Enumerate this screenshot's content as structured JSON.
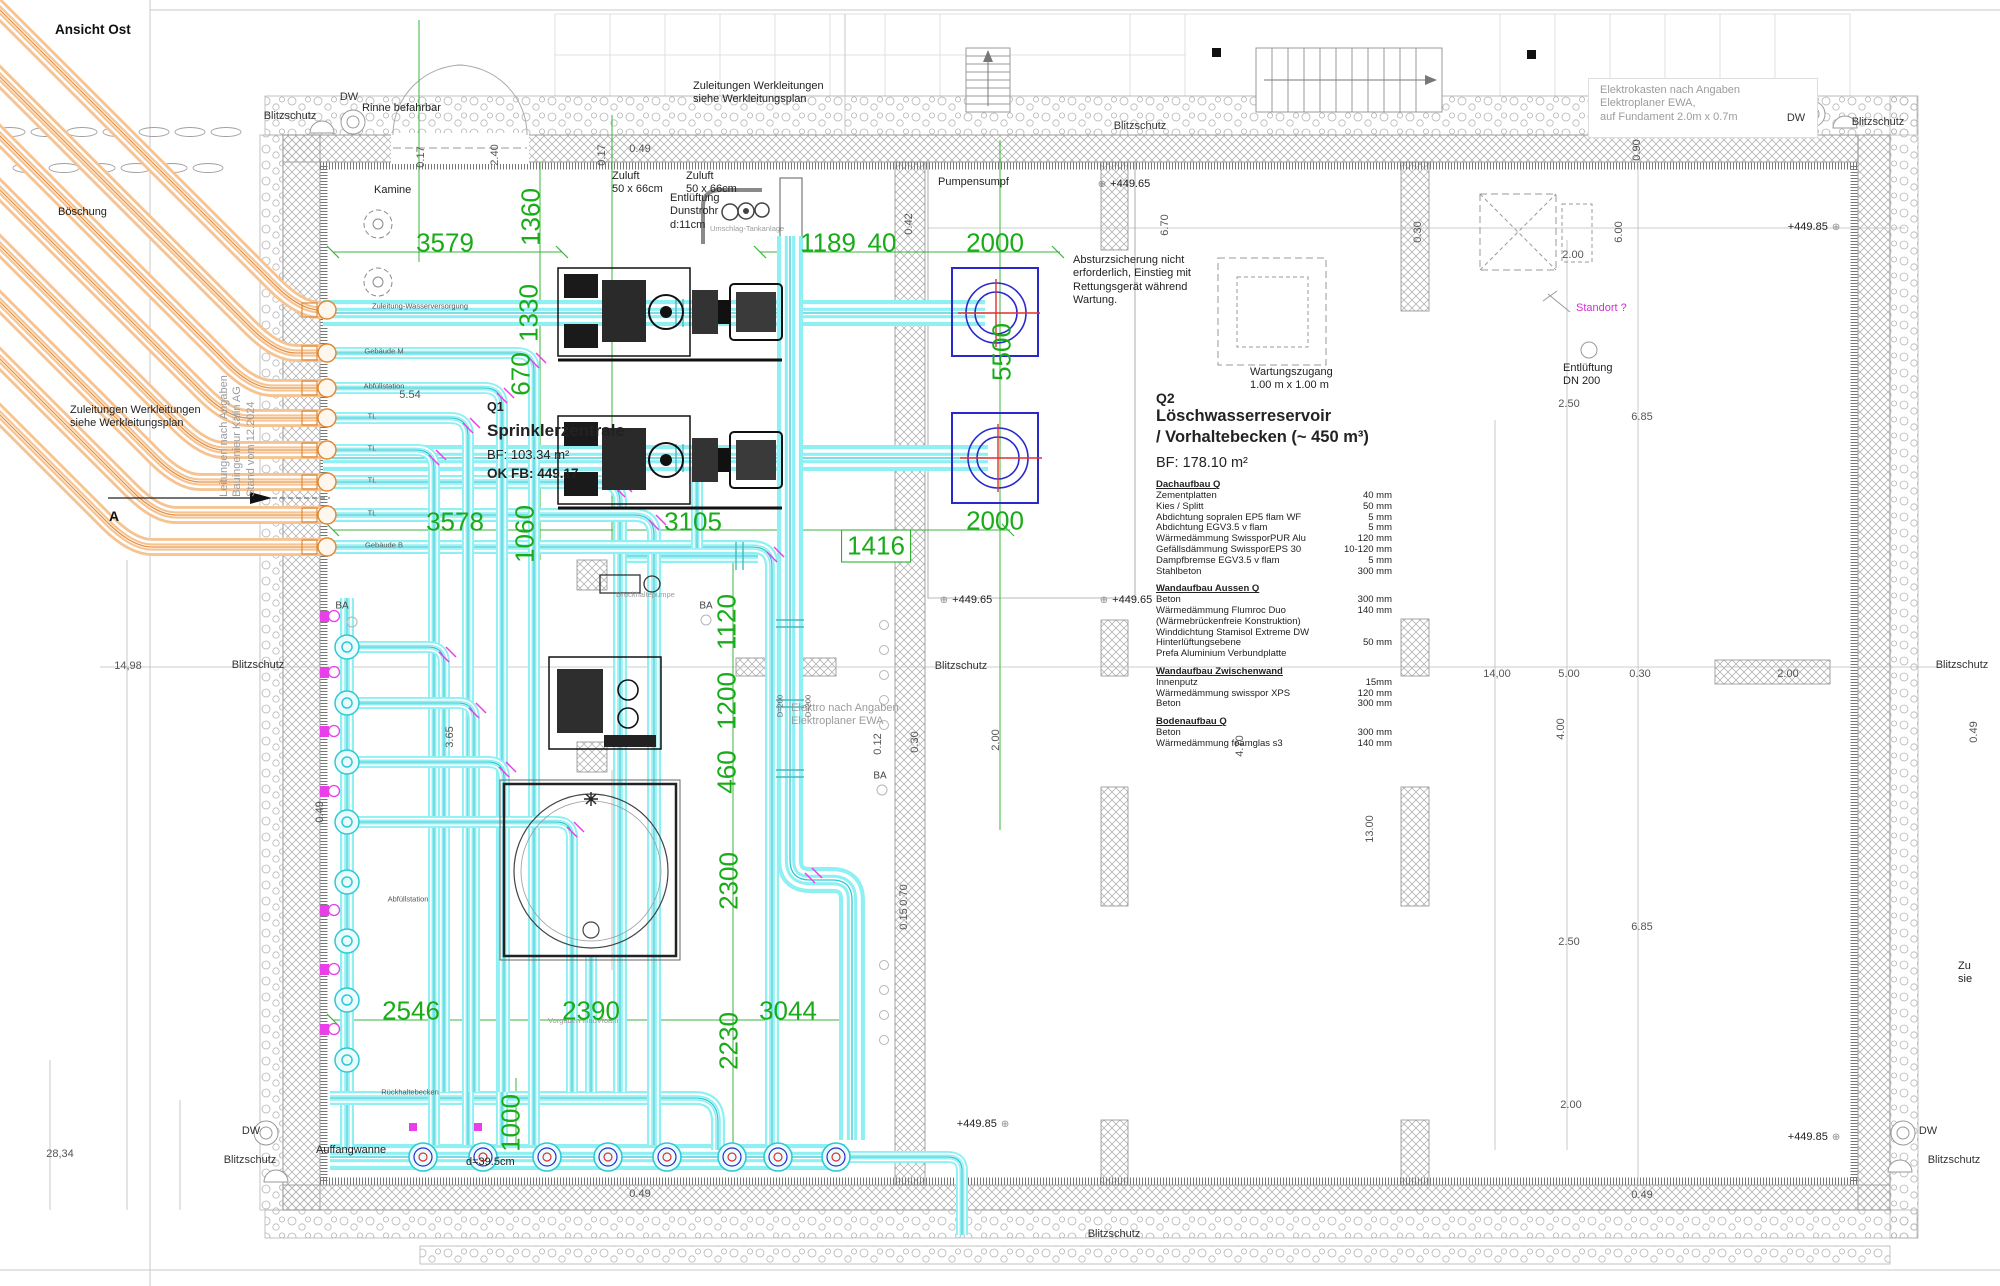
{
  "view_label": "Ansicht Ost",
  "colors": {
    "dimension_green": "#1aab1a",
    "pipe_cyan": "#7fedf2",
    "pipe_orange": "#f6c392",
    "pump_blue": "#2a2acc",
    "marker_magenta": "#e93fe9",
    "cross_red": "#e03030",
    "wall_gray": "#9a9a9a"
  },
  "rooms": {
    "q1": {
      "code": "Q1",
      "name": "Sprinklerzentrale",
      "bf": "BF: 103.34 m²",
      "ok_fb": "OK FB: 449.17"
    },
    "q2": {
      "code": "Q2",
      "title": [
        "Löschwasserreservoir",
        "/ Vorhaltebecken (~ 450 m³)"
      ],
      "bf": "BF: 178.10 m²",
      "sections": [
        {
          "h": "Dachaufbau Q",
          "rows": [
            [
              "Zementplatten",
              "40 mm"
            ],
            [
              "Kies / Splitt",
              "50 mm"
            ],
            [
              "Abdichtung sopralen EP5 flam WF",
              "5 mm"
            ],
            [
              "Abdichtung EGV3.5 v flam",
              "5 mm"
            ],
            [
              "Wärmedämmung SwissporPUR Alu",
              "120 mm"
            ],
            [
              "Gefällsdämmung SwissporEPS 30",
              "10-120 mm"
            ],
            [
              "Dampfbremse EGV3.5 v flam",
              "5 mm"
            ],
            [
              "Stahlbeton",
              "300 mm"
            ]
          ]
        },
        {
          "h": "Wandaufbau Aussen Q",
          "rows": [
            [
              "Beton",
              "300 mm"
            ],
            [
              "Wärmedämmung Flumroc Duo",
              "140 mm"
            ],
            [
              "(Wärmebrückenfreie Konstruktion)",
              ""
            ],
            [
              "Winddichtung Stamisol Extreme DW",
              ""
            ],
            [
              "Hinterlüftungsebene",
              "50 mm"
            ],
            [
              "Prefa Aluminium Verbundplatte",
              ""
            ]
          ]
        },
        {
          "h": "Wandaufbau Zwischenwand",
          "rows": [
            [
              "Innenputz",
              "15mm"
            ],
            [
              "Wärmedämmung swisspor XPS",
              "120 mm"
            ],
            [
              "Beton",
              "300 mm"
            ]
          ]
        },
        {
          "h": "Bodenaufbau Q",
          "rows": [
            [
              "Beton",
              "300 mm"
            ],
            [
              "Wärmedämmung foamglas s3",
              "140 mm"
            ]
          ]
        }
      ]
    }
  },
  "annotations": {
    "notes": [
      {
        "t": [
          "Zuleitungen Werkleitungen",
          "siehe Werkleitungsplan"
        ],
        "x": 693,
        "y": 80
      },
      {
        "t": [
          "Zuleitungen Werkleitungen",
          "siehe Werkleitungsplan"
        ],
        "x": 70,
        "y": 404
      },
      {
        "t": [
          "Elektrokasten nach Angaben",
          "Elektroplaner EWA,",
          "auf Fundament 2.0m x 0.7m"
        ],
        "x": 1600,
        "y": 84,
        "cls": "gray"
      },
      {
        "t": [
          "Absturzsicherung nicht",
          "erforderlich, Einstieg mit",
          "Rettungsgerät während",
          "Wartung."
        ],
        "x": 1073,
        "y": 254
      },
      {
        "t": [
          "Wartungszugang",
          "1.00 m x 1.00 m"
        ],
        "x": 1250,
        "y": 366
      },
      {
        "t": [
          "Elektro nach Angaben",
          "Elektroplaner EWA"
        ],
        "x": 791,
        "y": 702,
        "cls": "gray"
      },
      {
        "t": [
          "Entlüftung",
          "DN 200"
        ],
        "x": 1563,
        "y": 362
      },
      {
        "t": [
          "Zuluft",
          "50 x 66cm"
        ],
        "x": 612,
        "y": 170
      },
      {
        "t": [
          "Zuluft",
          "50 x 66cm"
        ],
        "x": 686,
        "y": 170
      },
      {
        "t": [
          "Entlüftung",
          "Dunstrohr",
          "d:11cm"
        ],
        "x": 670,
        "y": 192
      },
      {
        "t": [
          "Böschung"
        ],
        "x": 58,
        "y": 206
      },
      {
        "t": [
          "Rinne befahrbar"
        ],
        "x": 362,
        "y": 102
      },
      {
        "t": [
          "Kamine"
        ],
        "x": 374,
        "y": 184
      },
      {
        "t": [
          "Pumpensumpf"
        ],
        "x": 938,
        "y": 176
      },
      {
        "t": [
          "Standort ?"
        ],
        "x": 1576,
        "y": 302,
        "cls": "mag"
      },
      {
        "t": [
          "Auffangwanne"
        ],
        "x": 316,
        "y": 1144
      },
      {
        "t": [
          "Zu",
          "sie"
        ],
        "x": 1958,
        "y": 960
      },
      {
        "t": [
          "Leitungen nach Angaben",
          "Bauingenieur Kälin AG",
          "Stand vom 12.2024"
        ],
        "x": 238,
        "y": 436,
        "cls": "gray",
        "rot": -90
      },
      {
        "t": [
          "Umschlag-Tankanlage"
        ],
        "x": 710,
        "y": 224,
        "cls": "tiny gray"
      },
      {
        "t": [
          "d=39.5cm"
        ],
        "x": 466,
        "y": 1156
      },
      {
        "t": [
          "Vorgaben InnoVfoam"
        ],
        "x": 548,
        "y": 1016,
        "cls": "tiny gray"
      },
      {
        "t": [
          "Druckhaltepumpe"
        ],
        "x": 616,
        "y": 590,
        "cls": "tiny gray"
      }
    ],
    "labels": [
      {
        "t": "Blitzschutz",
        "x": 290,
        "y": 116
      },
      {
        "t": "Blitzschutz",
        "x": 1140,
        "y": 126
      },
      {
        "t": "Blitzschutz",
        "x": 1878,
        "y": 122
      },
      {
        "t": "Blitzschutz",
        "x": 258,
        "y": 665
      },
      {
        "t": "Blitzschutz",
        "x": 961,
        "y": 666
      },
      {
        "t": "Blitzschutz",
        "x": 1962,
        "y": 665
      },
      {
        "t": "Blitzschutz",
        "x": 250,
        "y": 1160
      },
      {
        "t": "Blitzschutz",
        "x": 1954,
        "y": 1160
      },
      {
        "t": "Blitzschutz",
        "x": 1114,
        "y": 1234
      },
      {
        "t": "DW",
        "x": 349,
        "y": 97
      },
      {
        "t": "DW",
        "x": 1796,
        "y": 118
      },
      {
        "t": "DW",
        "x": 251,
        "y": 1131
      },
      {
        "t": "DW",
        "x": 1928,
        "y": 1131
      },
      {
        "t": "A",
        "x": 114,
        "y": 516,
        "cls": "bold14"
      },
      {
        "t": "BA",
        "x": 342,
        "y": 606,
        "cls": "s10"
      },
      {
        "t": "BA",
        "x": 706,
        "y": 606,
        "cls": "s10"
      },
      {
        "t": "BA",
        "x": 880,
        "y": 776,
        "cls": "s10"
      },
      {
        "t": "Zuleitung-Wasserversorgung",
        "x": 420,
        "y": 306,
        "cls": "t7"
      },
      {
        "t": "Gebäude M",
        "x": 384,
        "y": 351,
        "cls": "t7"
      },
      {
        "t": "Abfüllstation",
        "x": 384,
        "y": 386,
        "cls": "t7"
      },
      {
        "t": "TL",
        "x": 372,
        "y": 416,
        "cls": "t7"
      },
      {
        "t": "TL",
        "x": 372,
        "y": 448,
        "cls": "t7"
      },
      {
        "t": "TL",
        "x": 372,
        "y": 480,
        "cls": "t7"
      },
      {
        "t": "TL",
        "x": 372,
        "y": 513,
        "cls": "t7"
      },
      {
        "t": "Gebäude B",
        "x": 384,
        "y": 545,
        "cls": "t7"
      },
      {
        "t": "Abfüllstation",
        "x": 408,
        "y": 899,
        "cls": "t7"
      },
      {
        "t": "Rückhaltebecken",
        "x": 410,
        "y": 1092,
        "cls": "t7"
      },
      {
        "t": "D=200",
        "x": 780,
        "y": 706,
        "cls": "t7",
        "rot": -90
      },
      {
        "t": "D=200",
        "x": 808,
        "y": 706,
        "cls": "t7",
        "rot": -90
      }
    ],
    "dims_green": [
      {
        "t": "3579",
        "x": 445,
        "y": 243
      },
      {
        "t": "1360",
        "x": 531,
        "y": 217,
        "r": -90
      },
      {
        "t": "1330",
        "x": 529,
        "y": 313,
        "r": -90
      },
      {
        "t": "670",
        "x": 521,
        "y": 374,
        "r": -90
      },
      {
        "t": "1189",
        "x": 828,
        "y": 243
      },
      {
        "t": "40",
        "x": 882,
        "y": 243
      },
      {
        "t": "2000",
        "x": 995,
        "y": 243
      },
      {
        "t": "5500",
        "x": 1002,
        "y": 352,
        "r": -90
      },
      {
        "t": "2000",
        "x": 995,
        "y": 521
      },
      {
        "t": "3578",
        "x": 455,
        "y": 522
      },
      {
        "t": "3105",
        "x": 693,
        "y": 522
      },
      {
        "t": "1416",
        "x": 876,
        "y": 546,
        "box": true
      },
      {
        "t": "1060",
        "x": 525,
        "y": 534,
        "r": -90
      },
      {
        "t": "1120",
        "x": 727,
        "y": 622,
        "r": -90
      },
      {
        "t": "1200",
        "x": 727,
        "y": 701,
        "r": -90
      },
      {
        "t": "460",
        "x": 727,
        "y": 772,
        "r": -90
      },
      {
        "t": "2300",
        "x": 729,
        "y": 881,
        "r": -90
      },
      {
        "t": "1000",
        "x": 511,
        "y": 1123,
        "r": -90
      },
      {
        "t": "2546",
        "x": 411,
        "y": 1011
      },
      {
        "t": "2390",
        "x": 591,
        "y": 1011
      },
      {
        "t": "3044",
        "x": 788,
        "y": 1011
      },
      {
        "t": "2230",
        "x": 729,
        "y": 1041,
        "r": -90
      }
    ],
    "dims_gray": [
      {
        "t": "0.17",
        "x": 421,
        "y": 157,
        "r": -90
      },
      {
        "t": "2.40",
        "x": 495,
        "y": 155,
        "r": -90
      },
      {
        "t": "0.17",
        "x": 602,
        "y": 155,
        "r": -90
      },
      {
        "t": "0.49",
        "x": 640,
        "y": 149
      },
      {
        "t": "0.42",
        "x": 909,
        "y": 224,
        "r": -90
      },
      {
        "t": "6.70",
        "x": 1165,
        "y": 225,
        "r": -90
      },
      {
        "t": "0.30",
        "x": 1418,
        "y": 232,
        "r": -90
      },
      {
        "t": "2.00",
        "x": 1573,
        "y": 255
      },
      {
        "t": "6.00",
        "x": 1619,
        "y": 232,
        "r": -90
      },
      {
        "t": "0.90",
        "x": 1637,
        "y": 150,
        "r": -90
      },
      {
        "t": "5.54",
        "x": 410,
        "y": 395
      },
      {
        "t": "3.65",
        "x": 450,
        "y": 737,
        "r": -90
      },
      {
        "t": "0.49",
        "x": 320,
        "y": 812,
        "r": -90
      },
      {
        "t": "14,98",
        "x": 128,
        "y": 666
      },
      {
        "t": "28,34",
        "x": 60,
        "y": 1154
      },
      {
        "t": "0.12",
        "x": 878,
        "y": 744,
        "r": -90
      },
      {
        "t": "0.30",
        "x": 915,
        "y": 742,
        "r": -90
      },
      {
        "t": "2.00",
        "x": 996,
        "y": 740,
        "r": -90
      },
      {
        "t": "0.70",
        "x": 904,
        "y": 895,
        "r": -90
      },
      {
        "t": "0.15",
        "x": 904,
        "y": 919,
        "r": -90
      },
      {
        "t": "14,00",
        "x": 1497,
        "y": 674
      },
      {
        "t": "5.00",
        "x": 1569,
        "y": 674
      },
      {
        "t": "0.30",
        "x": 1640,
        "y": 674
      },
      {
        "t": "2.00",
        "x": 1788,
        "y": 674
      },
      {
        "t": "4.00",
        "x": 1561,
        "y": 729,
        "r": -90
      },
      {
        "t": "4.70",
        "x": 1240,
        "y": 746,
        "r": -90
      },
      {
        "t": "13.00",
        "x": 1370,
        "y": 829,
        "r": -90
      },
      {
        "t": "6.85",
        "x": 1642,
        "y": 417
      },
      {
        "t": "2.50",
        "x": 1569,
        "y": 404
      },
      {
        "t": "2.50",
        "x": 1569,
        "y": 942
      },
      {
        "t": "6.85",
        "x": 1642,
        "y": 927
      },
      {
        "t": "2.00",
        "x": 1571,
        "y": 1105
      },
      {
        "t": "0.49",
        "x": 640,
        "y": 1194
      },
      {
        "t": "0.49",
        "x": 1642,
        "y": 1195
      },
      {
        "t": "0.49",
        "x": 1974,
        "y": 732,
        "r": -90
      }
    ],
    "levels": [
      {
        "t": "+449.65",
        "x": 1124,
        "y": 184,
        "sym": "left"
      },
      {
        "t": "+449.65",
        "x": 966,
        "y": 600,
        "sym": "left"
      },
      {
        "t": "+449.65",
        "x": 1126,
        "y": 600,
        "sym": "left"
      },
      {
        "t": "+449.85",
        "x": 1814,
        "y": 227,
        "sym": "right"
      },
      {
        "t": "+449.85",
        "x": 983,
        "y": 1124,
        "sym": "right"
      },
      {
        "t": "+449.85",
        "x": 1814,
        "y": 1137,
        "sym": "right"
      }
    ]
  }
}
